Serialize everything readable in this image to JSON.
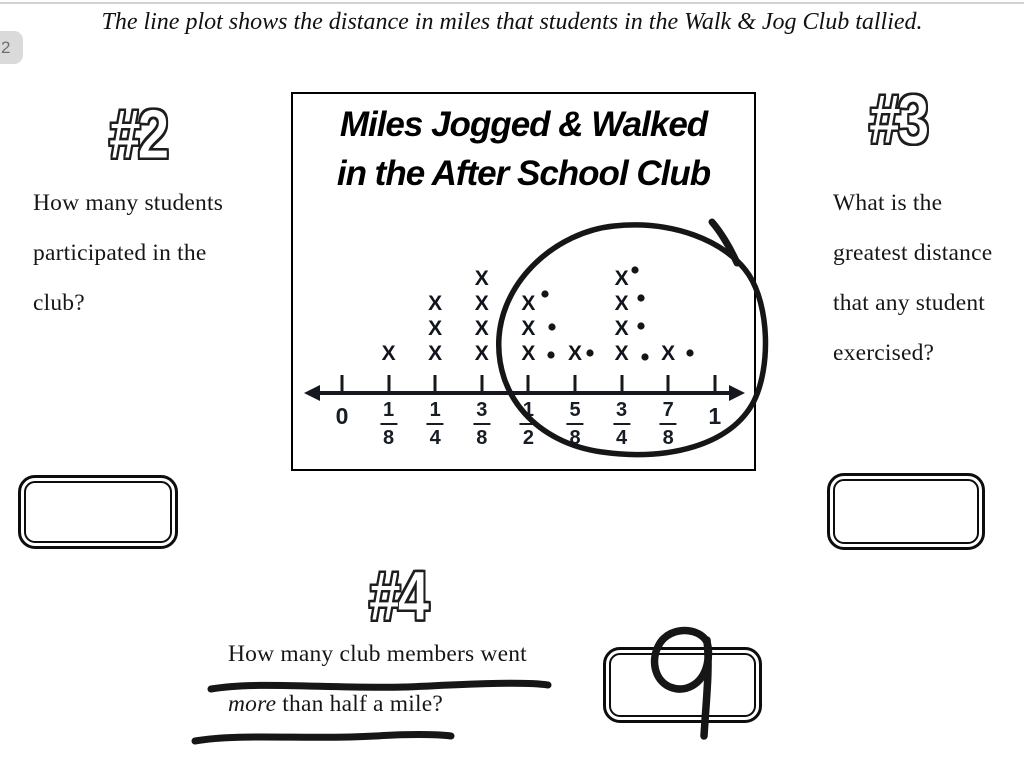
{
  "page": {
    "tab_label": "2",
    "instruction": "The line plot shows the distance in miles that students in the Walk & Jog Club tallied."
  },
  "chart_data": {
    "type": "line_plot",
    "title": "Miles Jogged & Walked in the After School Club",
    "title_lines": [
      "Miles Jogged & Walked",
      "in the After School Club"
    ],
    "categories": [
      "0",
      "1/8",
      "1/4",
      "3/8",
      "1/2",
      "5/8",
      "3/4",
      "7/8",
      "1"
    ],
    "counts": [
      0,
      1,
      3,
      4,
      3,
      1,
      4,
      1,
      0
    ],
    "mark_symbol": "X",
    "xlabel": "",
    "ylabel": "",
    "axis": {
      "min_label": "0",
      "max_label": "1",
      "grid": false
    }
  },
  "questions": {
    "q2": {
      "number": "#2",
      "lines": [
        "How many students",
        "participated in the",
        "club?"
      ]
    },
    "q3": {
      "number": "#3",
      "lines": [
        "What is the",
        "greatest distance",
        "that any student",
        "exercised?"
      ]
    },
    "q4": {
      "number": "#4",
      "line1": "How many club members went",
      "line2_italic_word": "more",
      "line2_rest": " than half a mile?"
    }
  },
  "answers": {
    "q2_box": "",
    "q3_box": "",
    "q4_handwritten": "9"
  },
  "annotations": {
    "circled_region": "hand-drawn pen circle around plot values 1/2 through 1",
    "count_dots": {
      "count": 9,
      "positions": [
        [
          545,
          294
        ],
        [
          552,
          327
        ],
        [
          551,
          355
        ],
        [
          590,
          353
        ],
        [
          635,
          270
        ],
        [
          641,
          298
        ],
        [
          641,
          326
        ],
        [
          645,
          357
        ],
        [
          690,
          353
        ]
      ]
    },
    "underline_count": 2
  }
}
